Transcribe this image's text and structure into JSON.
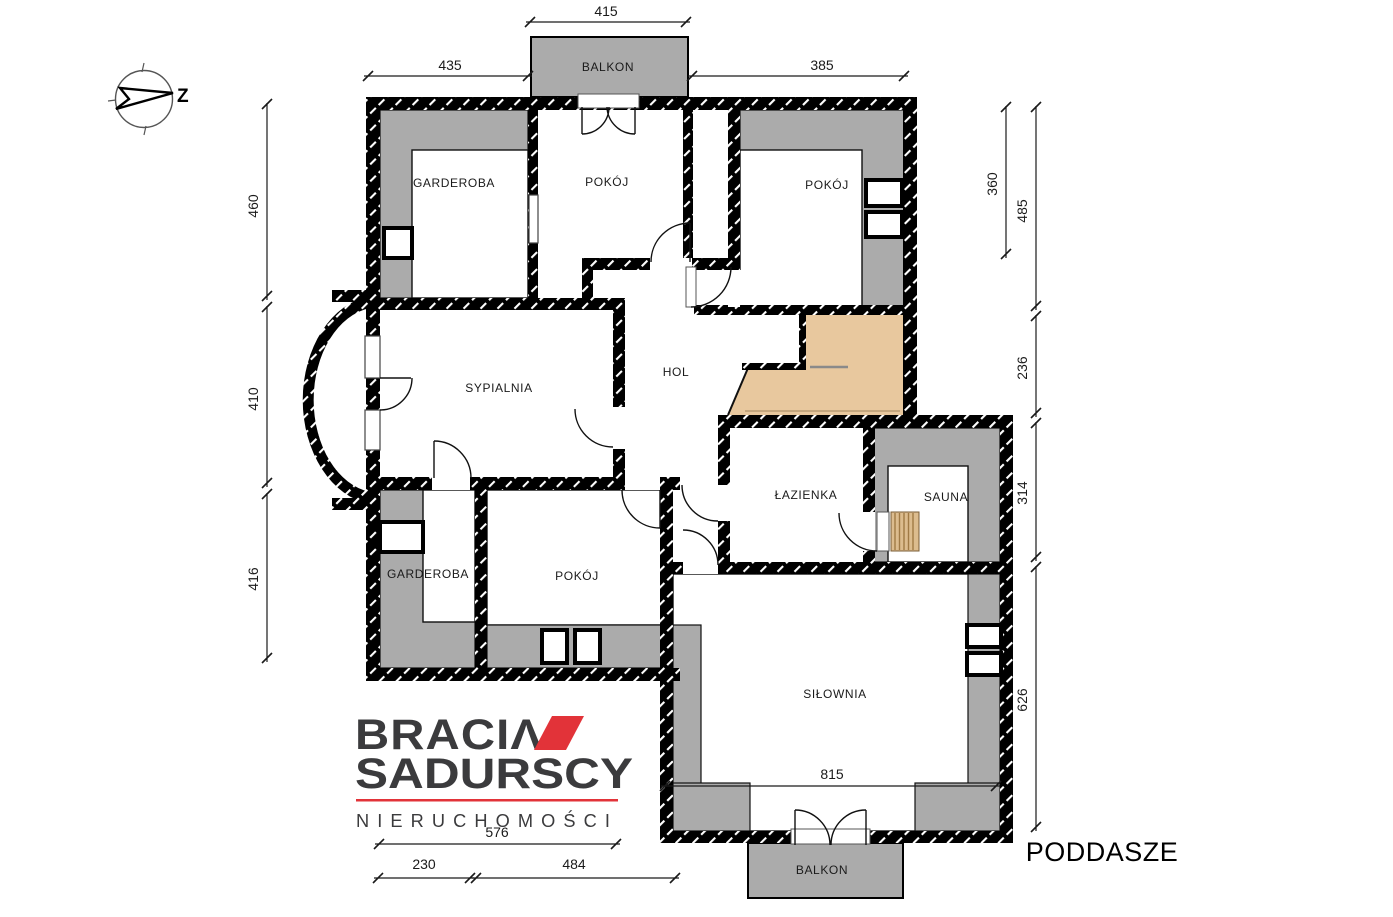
{
  "title": "PODDASZE",
  "compass": {
    "label": "Z"
  },
  "logo": {
    "line1": "BRACIΛ",
    "line2": "SADURSCY",
    "line3": "NIERUCHOMOŚCI"
  },
  "watermark": "BRACIA SADURSCY",
  "rooms": {
    "garderoba_top": "GARDEROBA",
    "pokoj_top": "POKÓJ",
    "pokoj_right": "POKÓJ",
    "sypialnia": "SYPIALNIA",
    "hol": "HOL",
    "lazienka": "ŁAZIENKA",
    "sauna": "SAUNA",
    "garderoba_bottom": "GARDEROBA",
    "pokoj_bottom": "POKÓJ",
    "silownia": "SIŁOWNIA",
    "balkon_top": "BALKON",
    "balkon_bottom": "BALKON"
  },
  "dimensions": {
    "top_balcony": "415",
    "top_left": "435",
    "top_right": "385",
    "left_upper": "460",
    "left_middle": "410",
    "left_lower": "416",
    "right_inner": "360",
    "right_upper": "485",
    "right_mid1": "236",
    "right_mid2": "314",
    "right_lower": "626",
    "silownia_width": "815",
    "bottom_logo": "576",
    "bottom_left": "230",
    "bottom_right": "484"
  },
  "colors": {
    "wall": "#000000",
    "attic_gray": "#ababab",
    "stairs": "#e8c89e",
    "bench": "#dcbc8e",
    "bench_stripe": "#a07a45",
    "logo_dark": "#3b3b3d",
    "logo_red": "#e23339"
  }
}
